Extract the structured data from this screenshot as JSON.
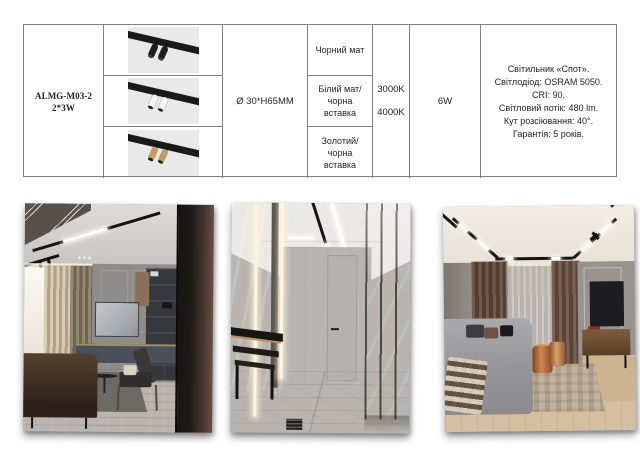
{
  "spec_table": {
    "product_code": "ALMG-M03-2 2*3W",
    "dimensions": "Ø 30*H65MM",
    "power": "6W",
    "color_temperatures": [
      "3000K",
      "4000K"
    ],
    "variants": [
      {
        "finish_label": "Чорний мат",
        "finish_color": "#1e1e1e",
        "tip_color": "#404040"
      },
      {
        "finish_label": "Білий мат/чорна вставка",
        "finish_color": "#f4f4f4",
        "tip_color": "#222222"
      },
      {
        "finish_label": "Золотий/чорна вставка",
        "finish_color": "#c39c62",
        "tip_color": "#1c1c1c"
      }
    ],
    "description_lines": [
      "Світильник «Спот».",
      "Світлодіод: OSRAM 5050. CRI: 90.",
      "Світловий потік: 480 lm.",
      "Кут розсіювання: 40°.",
      "Гарантія: 5 років."
    ],
    "style": {
      "border_color": "#808080",
      "text_color": "#1f1f1f",
      "render_bg": "#e9e9e9",
      "track_color": "#1a1a1a"
    }
  },
  "gallery": {
    "photos": [
      {
        "name": "interior-living-room-office-with-track-spots"
      },
      {
        "name": "interior-hallway-linear-led-marble-floor"
      },
      {
        "name": "interior-living-room-perimeter-magnetic-track"
      }
    ]
  }
}
